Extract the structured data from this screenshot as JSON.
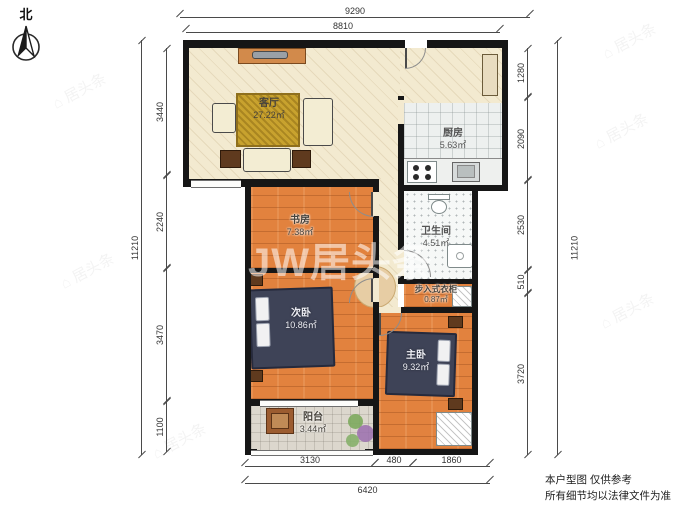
{
  "compass": {
    "label": "北"
  },
  "dims": {
    "top_outer": "9290",
    "top_inner": "8810",
    "left_outer": "11210",
    "left_segs": [
      "3440",
      "2240",
      "3470",
      "1100"
    ],
    "right_outer": "11210",
    "right_segs": [
      "1280",
      "2090",
      "2530",
      "510",
      "3720"
    ],
    "bottom_segs": [
      "3130",
      "480",
      "1860"
    ],
    "bottom_outer": "6420"
  },
  "rooms": [
    {
      "name": "客厅",
      "area": "27.22㎡"
    },
    {
      "name": "厨房",
      "area": "5.63㎡"
    },
    {
      "name": "书房",
      "area": "7.38㎡"
    },
    {
      "name": "卫生间",
      "area": "4.51㎡"
    },
    {
      "name": "步入式衣柜",
      "area": "0.87㎡"
    },
    {
      "name": "次卧",
      "area": "10.86㎡"
    },
    {
      "name": "主卧",
      "area": "9.32㎡"
    },
    {
      "name": "阳台",
      "area": "3.44㎡"
    }
  ],
  "watermark": {
    "tile": "居头条",
    "center": "JW居头条"
  },
  "disclaimer": {
    "line1": "本户型图 仅供参考",
    "line2": "所有细节均以法律文件为准"
  },
  "colors": {
    "wall": "#161616",
    "wood_floor": "#e2823e",
    "beige_floor": "#f3ead0",
    "gold_rug": "#c8a22e",
    "bed": "#3e4357"
  }
}
